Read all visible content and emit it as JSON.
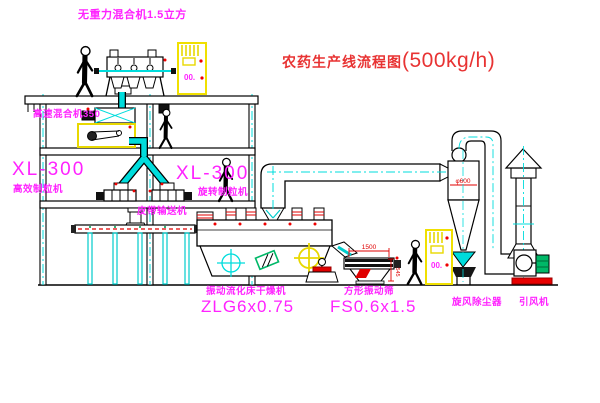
{
  "title": {
    "name_cn": "农药生产线流程图",
    "capacity": "(500kg/h)"
  },
  "labels": {
    "gravity_mixer": "无重力混合机1.5立方",
    "high_speed_mixer": "高速混合机350",
    "granulator_left_model": "XL-300",
    "granulator_left_name": "高效制粒机",
    "granulator_right_model": "XL-300",
    "granulator_right_name": "旋转制粒机",
    "belt_conveyor": "皮带输送机",
    "dryer_name": "振动流化床干燥机",
    "dryer_model": "ZLG6x0.75",
    "screen_name": "方形振动筛",
    "screen_model": "FS0.6x1.5",
    "cyclone_name": "旋风除尘器",
    "fan_name": "引风机"
  },
  "dimensions": {
    "screen_length": "1500",
    "screen_height": "545",
    "cyclone_diameter": "φ600"
  },
  "control_cabinets": {
    "cabinet1_display": "00.",
    "cabinet2_display": "00."
  },
  "colors": {
    "label_magenta": "#ff22ff",
    "title_red": "#e83333",
    "pipe_cyan": "#00dcdc",
    "cabinet_yellow": "#f0e000",
    "accent_red": "#ee0000",
    "motor_green": "#00b868",
    "line_black": "#000000"
  }
}
